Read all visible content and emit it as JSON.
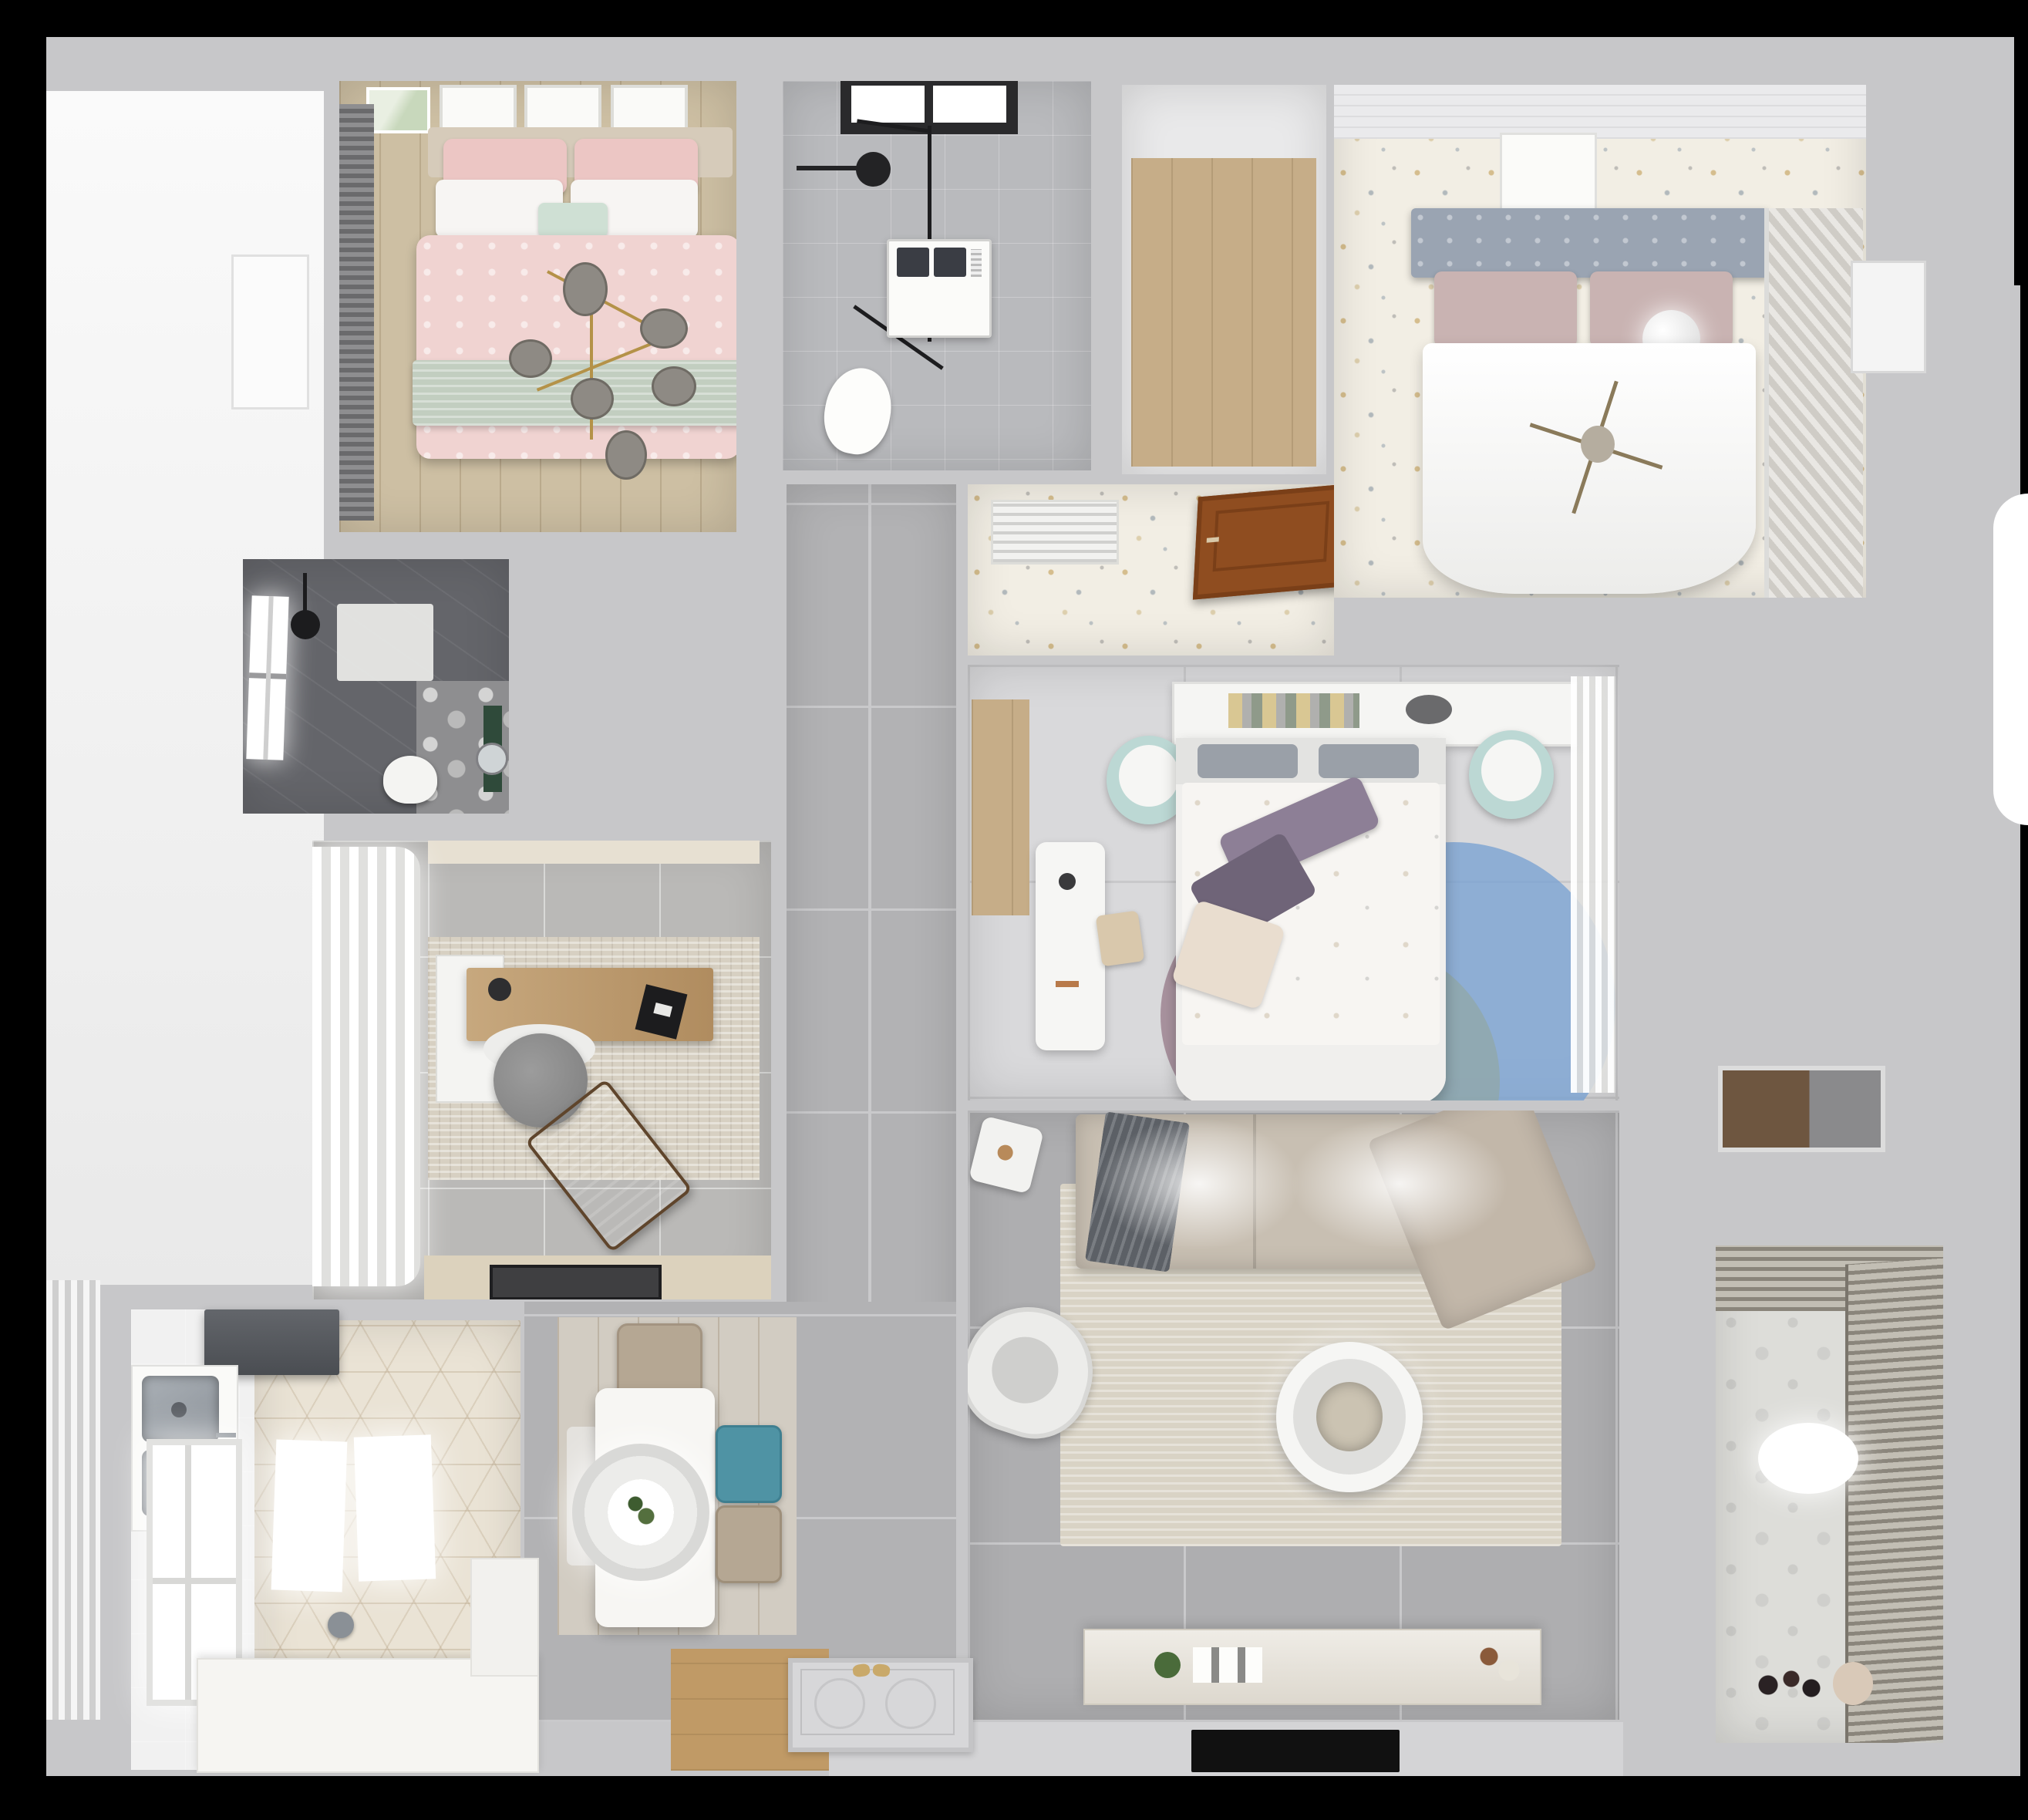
{
  "scene": {
    "description": "3D rendered top-down (dollhouse) floor plan of a furnished apartment on a black background",
    "view": "top-down cutaway render",
    "visible_text": "none"
  },
  "palette": {
    "bg": "#000000",
    "wallOuter": "#c7c7c9",
    "wallLight": "#dcdcde",
    "grout": "#c9c9cb",
    "exteriorWhite": "#f2f2f2",
    "corridorTile": "#b2b2b4",
    "livingTile": "#aeaeb0",
    "studyTile": "#bab9b7",
    "bathroomTile": "#b9babd",
    "bathroomDark": "#64656a",
    "bedroom2Floor": "#f2eee4",
    "bedroom3Floor": "#d9d9db",
    "woodBeige": "#cdbfa3",
    "woodPlank": "#c6ad88",
    "woodFoyer": "#c09a66",
    "doorBrown": "#8f4d20",
    "hexFloor": "#eae3d5",
    "balconyFloor": "#ddddd9",
    "pinkBed": "#f0d3d1",
    "pinkPillow": "#ecc6c4",
    "sageBlanket": "#c2cec0",
    "mint": "#cfe0d4",
    "headboardGray": "#9aa4b2",
    "mauvePillow": "#c9b3b2",
    "sofaGreige": "#c8bfb2",
    "throwGray": "#5c6066",
    "rugLiving": "#d9d3c5",
    "rugBeige": "#d7d0c2",
    "poufMint": "#bcd8d4",
    "rugBlue": "#7aa3d2",
    "rugMauve": "#8d6b7e",
    "rugTeal": "#92a6a4",
    "purplePillow": "#8d7f96",
    "darkPurple": "#6f6478",
    "cream": "#e9ddcf",
    "tealChair": "#4f93a4",
    "tanChair": "#b5a793",
    "steel": "#9ca2a8",
    "greenPlant": "#4a6b3a",
    "tvBlack": "#111111"
  },
  "rooms": [
    {
      "name": "Bedroom 1 - pink double bed, sage throw, branch chandelier, wall frames, roman blind, wood floor",
      "furniture": [
        "double-bed",
        "pink-duvet",
        "sage-blanket",
        "pillows",
        "branch-chandelier",
        "wall-frames",
        "roman-blind",
        "wood-floor"
      ]
    },
    {
      "name": "Bathroom 1 - walk-in shower with black glass frame, washing machine, toilet, black-framed window",
      "furniture": [
        "window",
        "shower-head",
        "glass-screen",
        "washing-machine",
        "toilet"
      ]
    },
    {
      "name": "Storage / walk-in closet with wood floor",
      "furniture": [
        "wood-floor"
      ]
    },
    {
      "name": "Bedroom 2 - master: gray tufted headboard, white duvet, sphere lamp, louvered wardrobe, terrazzo floor",
      "furniture": [
        "tufted-headboard",
        "mauve-pillows",
        "white-duvet",
        "sphere-lamp",
        "cross-chandelier",
        "louvered-wardrobe",
        "wall-art"
      ]
    },
    {
      "name": "Hallway to master bedroom - air vent and open wooden door on terrazzo floor",
      "furniture": [
        "air-vent",
        "open-wood-door"
      ]
    },
    {
      "name": "Bathroom 2 - dark tiled shower room with lit window, shower tray, toilet, green vanity, round mirror",
      "furniture": [
        "window",
        "shower-head",
        "shower-tray",
        "floral-tiles",
        "toilet",
        "green-vanity",
        "round-mirror"
      ]
    },
    {
      "name": "Study - sheer curtains, wooden desk with laptop, gray swivel chair, brown lounge chair, beige rug, door mat",
      "furniture": [
        "sheer-curtains",
        "desk",
        "laptop",
        "swivel-chair",
        "lounge-chair",
        "area-rug",
        "door-mat"
      ]
    },
    {
      "name": "Corridor - large gray floor tiles",
      "furniture": [
        "gray-tile-floor"
      ]
    },
    {
      "name": "Bedroom 3 - bed with floral duvet and purple pillows, headboard shelf with books, mint poufs, white desk, circle rug, sheer wardrobe curtains",
      "furniture": [
        "bed",
        "floral-duvet",
        "purple-pillows",
        "headboard-shelf",
        "books",
        "mint-poufs",
        "white-desk",
        "desk-chair",
        "circle-rug",
        "sheer-curtains",
        "wood-niche"
      ]
    },
    {
      "name": "Living room - corner sofa with gray throw, round layered coffee table, armchair, side table, TV console, rug",
      "furniture": [
        "corner-sofa",
        "gray-throw",
        "area-rug",
        "round-coffee-table",
        "armchair",
        "side-table",
        "tv-console",
        "ceiling-light-glow"
      ]
    },
    {
      "name": "Kitchen - hex patterned tile floor, double stainless sink, dark range hood, lit window, white counters",
      "furniture": [
        "range-hood",
        "double-sink",
        "counters",
        "window",
        "island-lights",
        "hex-floor"
      ]
    },
    {
      "name": "Dining - white table with round pendant light and plant centerpiece, teal and beige chairs on wood floor",
      "furniture": [
        "dining-table",
        "pendant-light",
        "plant-centerpiece",
        "teal-chair",
        "tan-chair",
        "top-chair",
        "side-chair",
        "wood-floor"
      ]
    },
    {
      "name": "Entry foyer - embossed door mat with slippers on wood floor",
      "furniture": [
        "door-mat",
        "slippers",
        "wood-floor"
      ]
    },
    {
      "name": "Balcony / laundry - roller blinds, patterned tile floor, ceiling light, toys, pouf",
      "furniture": [
        "roller-blinds",
        "ceiling-light",
        "toys",
        "pouf",
        "patterned-floor"
      ]
    },
    {
      "name": "Building corridor outside unit - white doors and wood niche",
      "furniture": [
        "white-door",
        "wood-niche"
      ]
    }
  ]
}
